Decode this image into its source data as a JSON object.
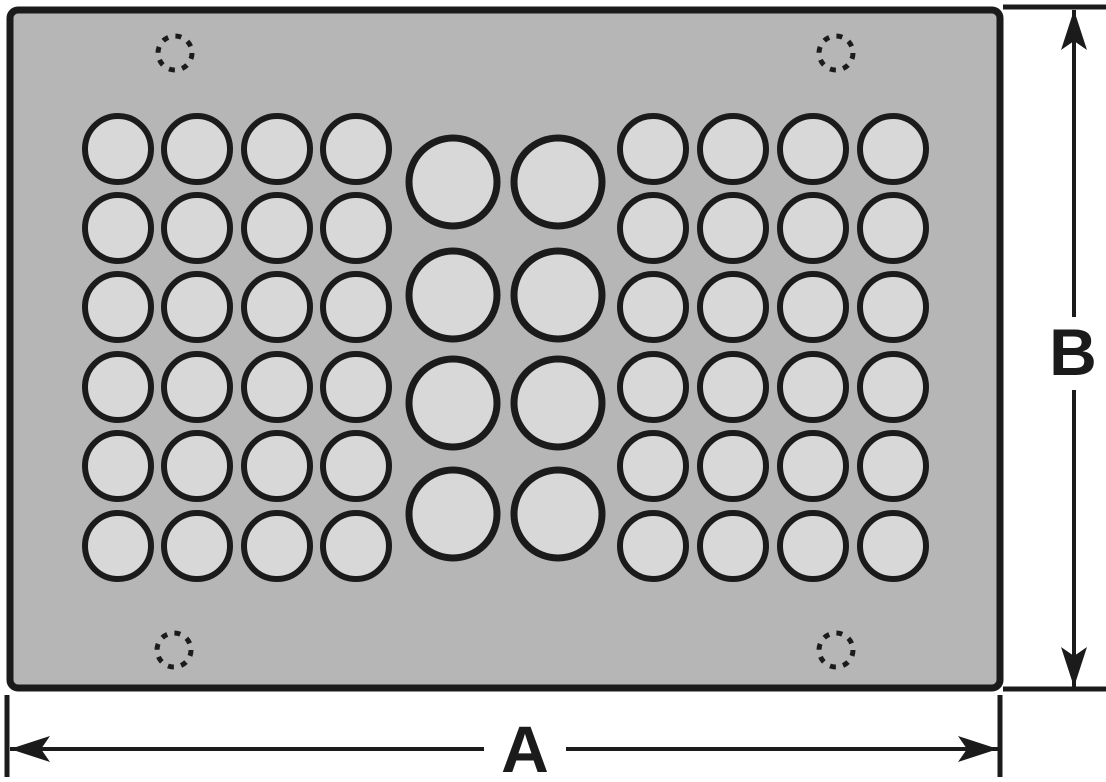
{
  "colors": {
    "background": "#ffffff",
    "panel_fill": "#b6b6b6",
    "hole_fill": "#d8d8d8",
    "line": "#1b1b1b"
  },
  "panel": {
    "x": 10,
    "y": 10,
    "width": 990,
    "height": 678,
    "corner_radius": 8,
    "border_width": 7
  },
  "corner_holes": {
    "radius": 17,
    "stroke_width": 5,
    "dash": "6 7.4",
    "centers": [
      [
        175,
        53
      ],
      [
        836,
        53
      ],
      [
        174,
        650
      ],
      [
        836,
        650
      ]
    ]
  },
  "hole_groups": [
    {
      "name": "left-hole-block",
      "radius": 33,
      "stroke_width": 6,
      "cols": [
        118,
        197,
        277,
        356
      ],
      "rows": [
        149,
        228,
        307,
        387,
        466,
        546
      ]
    },
    {
      "name": "middle-hole-block",
      "radius": 44,
      "stroke_width": 7,
      "cols": [
        453,
        558
      ],
      "rows": [
        182,
        295,
        403,
        514
      ]
    },
    {
      "name": "right-hole-block",
      "radius": 33,
      "stroke_width": 6,
      "cols": [
        653,
        733,
        813,
        893
      ],
      "rows": [
        149,
        228,
        307,
        387,
        466,
        546
      ]
    }
  ],
  "dimensions": {
    "a": {
      "label": "A",
      "line_y": 749,
      "from": 10,
      "to": 998,
      "gap": [
        484,
        566
      ],
      "label_x": 525,
      "label_y": 772,
      "extensions": [
        {
          "x": 7,
          "y1": 695,
          "y2": 777
        },
        {
          "x": 1000,
          "y1": 695,
          "y2": 777
        }
      ]
    },
    "b": {
      "label": "B",
      "line_x": 1074,
      "from": 10,
      "to": 687,
      "gap": [
        317,
        390
      ],
      "label_x": 1073,
      "label_y": 375,
      "extensions": [
        {
          "y": 7,
          "x1": 1003,
          "x2": 1106
        },
        {
          "y": 689,
          "x1": 1003,
          "x2": 1106
        }
      ]
    }
  },
  "arrow": {
    "length": 40,
    "half_width": 13,
    "notch": 31
  },
  "line_width": 4,
  "extension_line_width": 5,
  "label_font_size": 66
}
